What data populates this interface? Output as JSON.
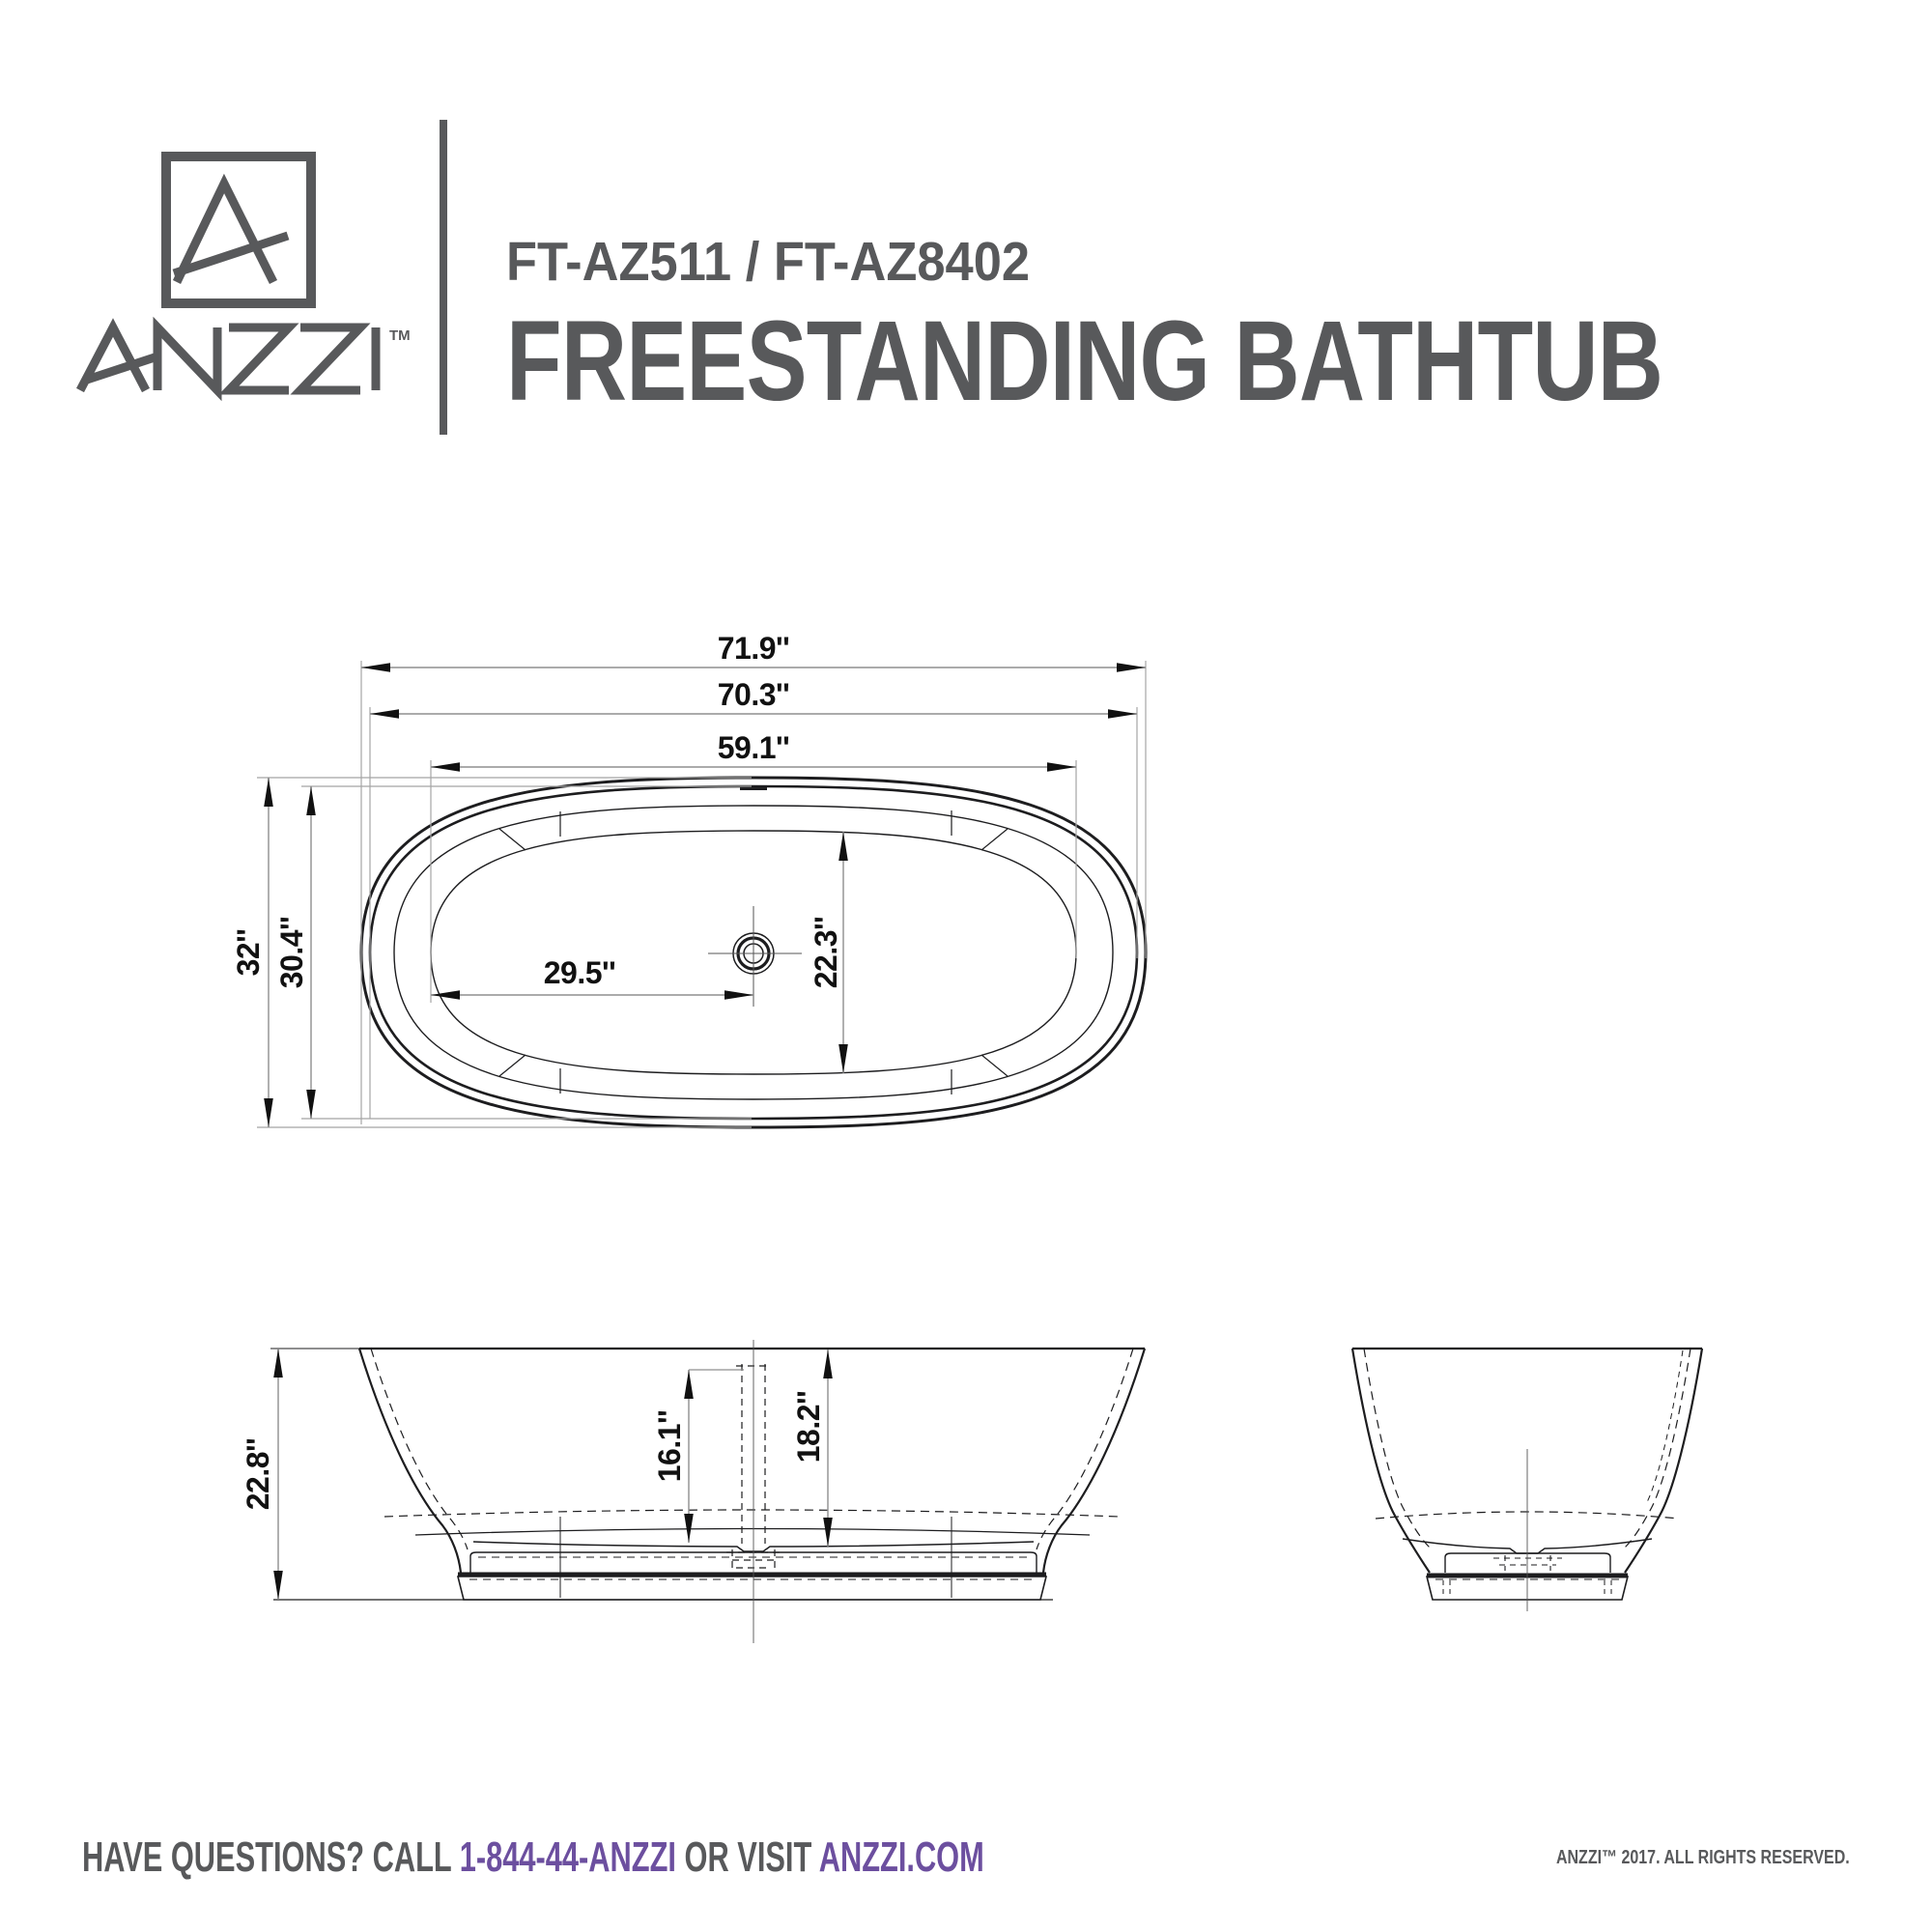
{
  "header": {
    "logo": {
      "brand": "ANZZI",
      "tm": "TM"
    },
    "model": "FT-AZ511 / FT-AZ8402",
    "product": "FREESTANDING BATHTUB"
  },
  "views": {
    "top": {
      "name": "top view",
      "labels": {
        "overall_length": "71.9''",
        "deck_length": "70.3''",
        "basin_length": "59.1''",
        "overall_width": "32''",
        "deck_width": "30.4''",
        "drain_from_end": "29.5''",
        "basin_width": "22.3''"
      }
    },
    "side": {
      "name": "side view",
      "labels": {
        "overall_height": "22.8''",
        "floor_to_overflow": "16.1''",
        "rim_to_floor": "18.2''"
      }
    },
    "end": {
      "name": "end view"
    }
  },
  "footer": {
    "call": "HAVE QUESTIONS? CALL",
    "phone": "1-844-44-ANZZI",
    "or_visit": "OR VISIT",
    "site": "ANZZI.COM",
    "copyright": "ANZZI™ 2017. ALL RIGHTS RESERVED."
  },
  "colors": {
    "brand_gray": "#58595B",
    "accent_purple": "#6C4F9F",
    "line": "#1D1D1F"
  }
}
